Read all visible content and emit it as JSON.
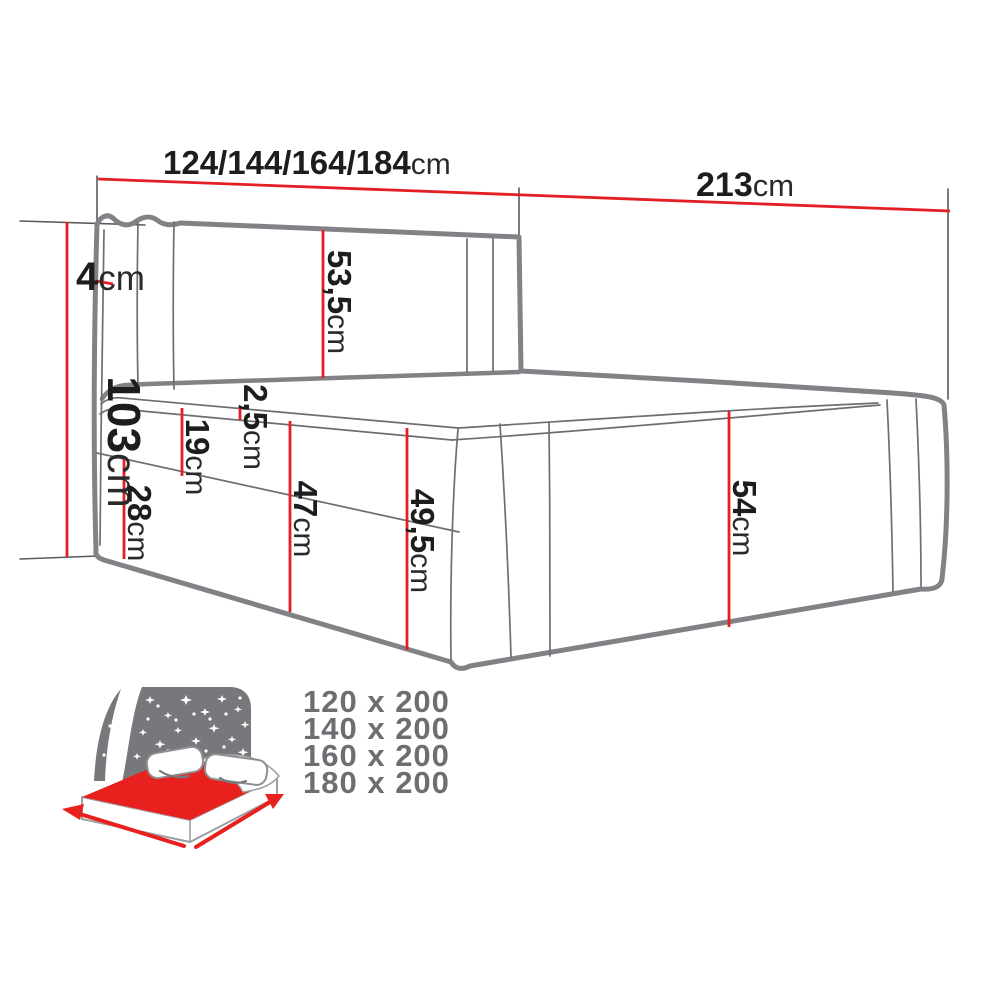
{
  "title": "Boxspring bed dimensions diagram",
  "colors": {
    "dimension_red": "#e31e24",
    "outline_thick_gray": "#808285",
    "outline_thin_gray": "#6d6e71",
    "text_black": "#1d1d1b",
    "icon_gray": "#77787b",
    "sizes_text_gray": "#6d6e71",
    "icon_red": "#e8201e"
  },
  "dimensions": {
    "width_options": {
      "value": "124/144/164/184",
      "unit": "cm"
    },
    "length": {
      "value": "213",
      "unit": "cm"
    },
    "total_height": {
      "value": "103",
      "unit": "cm"
    },
    "headboard_edge": {
      "value": "4",
      "unit": "cm"
    },
    "headboard_front_height": {
      "value": "53,5",
      "unit": "cm"
    },
    "mattress_top_band": {
      "value": "2,5",
      "unit": "cm"
    },
    "mattress_side_height": {
      "value": "19",
      "unit": "cm"
    },
    "base_corner_height": {
      "value": "28",
      "unit": "cm"
    },
    "front_height_no_band": {
      "value": "47",
      "unit": "cm"
    },
    "front_total_height": {
      "value": "49,5",
      "unit": "cm"
    },
    "side_total_height": {
      "value": "54",
      "unit": "cm"
    }
  },
  "available_sizes": [
    "120 x 200",
    "140 x 200",
    "160 x 200",
    "180 x 200"
  ],
  "icon": {
    "name": "bed-size-night-icon"
  }
}
